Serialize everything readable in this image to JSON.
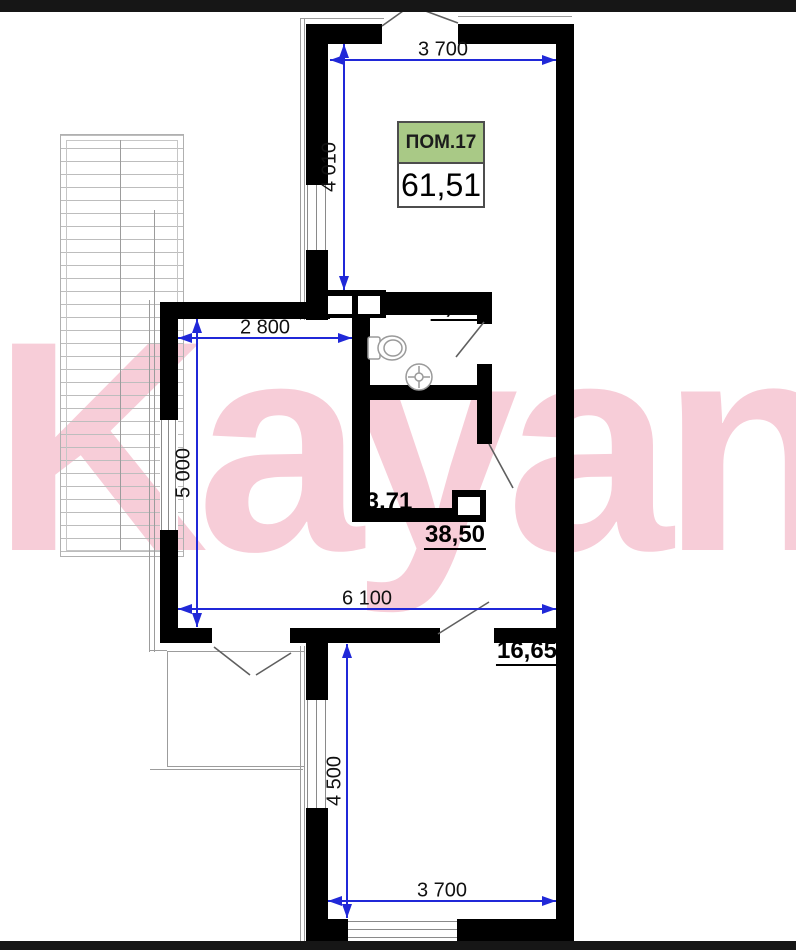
{
  "watermark": {
    "text": "Kayan",
    "color": "#f7cdd8"
  },
  "unit": {
    "name": "ПОМ.17",
    "total_area": "61,51",
    "label_color": "#a9c986"
  },
  "rooms": [
    {
      "name": "bathroom",
      "area": "2,65"
    },
    {
      "name": "storage",
      "area": "3,71"
    },
    {
      "name": "living-room",
      "area": "38,50"
    },
    {
      "name": "bedroom",
      "area": "16,65"
    }
  ],
  "dimensions": {
    "top_width": "3 700",
    "top_height": "4 010",
    "mid_width": "2 800",
    "mid_height": "5 000",
    "full_width": "6 100",
    "bottom_height": "4 500",
    "bottom_width": "3 700"
  },
  "colors": {
    "dimension_blue": "#2028d8",
    "wall_black": "#000000",
    "label_green": "#a9c986",
    "watermark_pink": "#f7cdd8"
  }
}
